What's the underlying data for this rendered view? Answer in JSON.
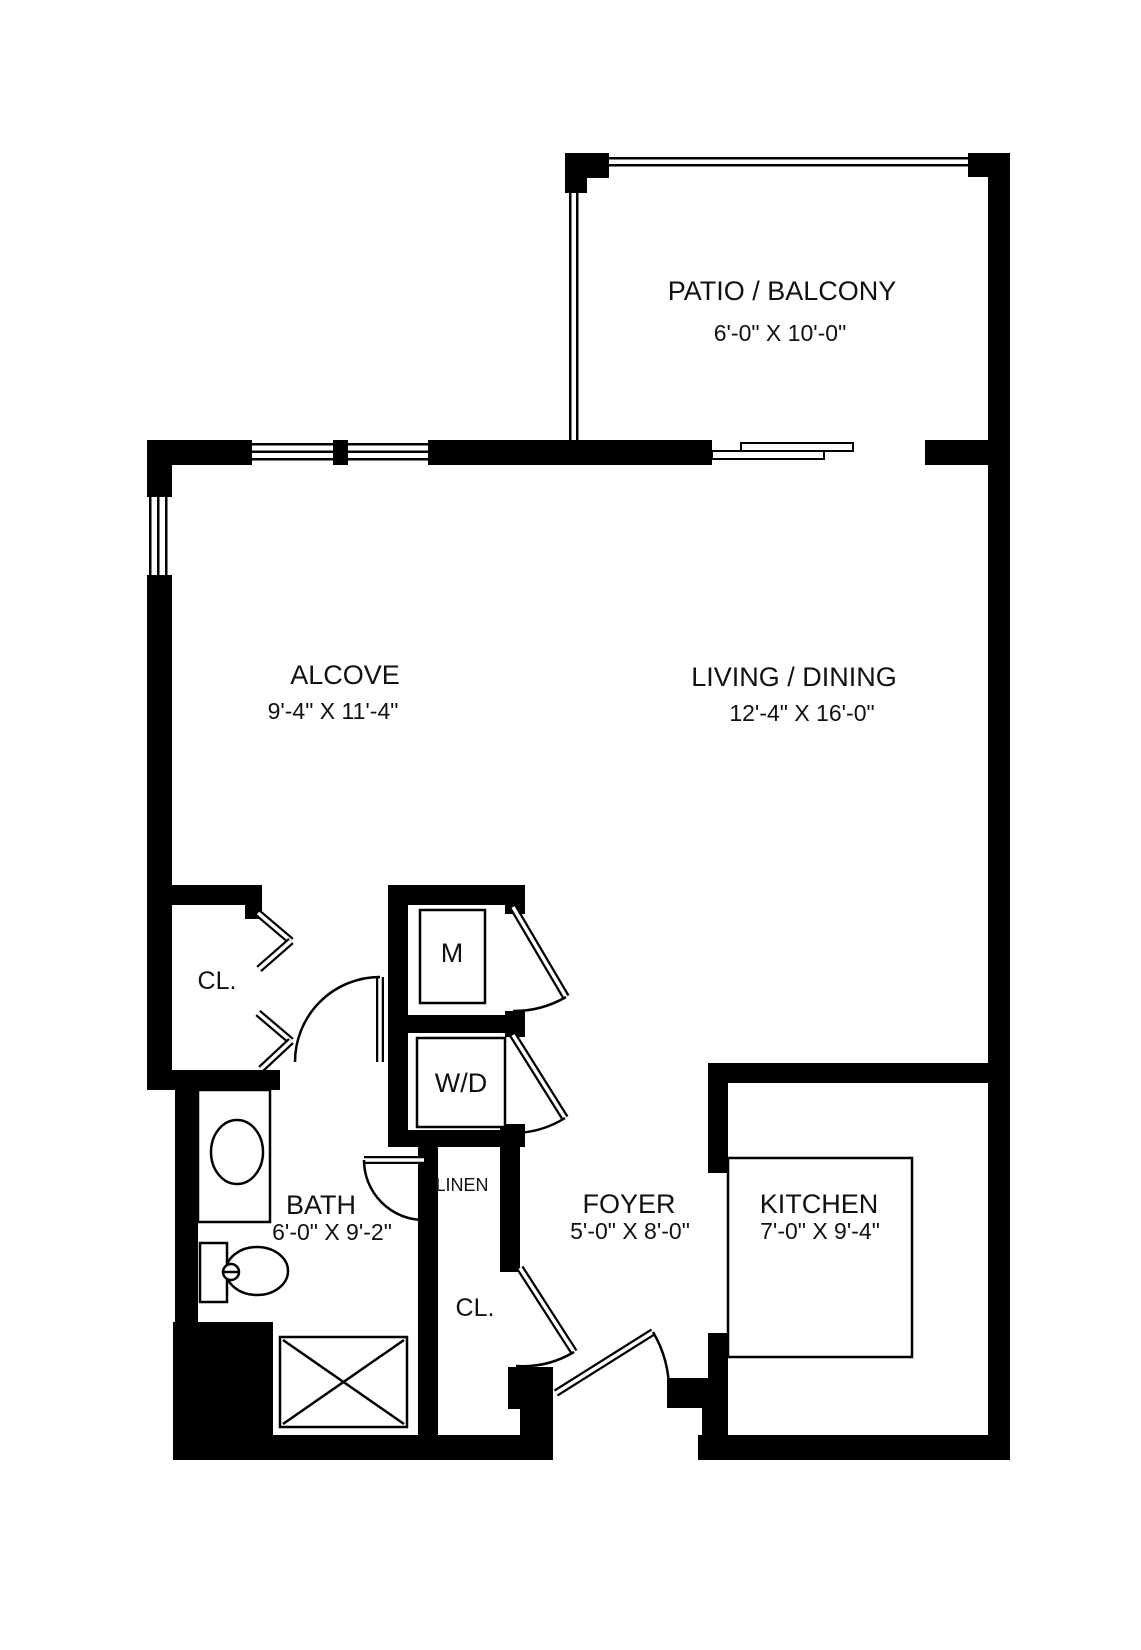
{
  "floor_plan": {
    "patio": {
      "name": "PATIO / BALCONY",
      "dims": "6'-0\" X 10'-0\""
    },
    "alcove": {
      "name": "ALCOVE",
      "dims": "9'-4\" X 11'-4\""
    },
    "living_dining": {
      "name": "LIVING / DINING",
      "dims": "12'-4\" X 16'-0\""
    },
    "bath": {
      "name": "BATH",
      "dims": "6'-0\" X 9'-2\""
    },
    "foyer": {
      "name": "FOYER",
      "dims": "5'-0\" X 8'-0\""
    },
    "kitchen": {
      "name": "KITCHEN",
      "dims": "7'-0\" X 9'-4\""
    },
    "alcove_closet": {
      "name": "CL."
    },
    "foyer_closet": {
      "name": "CL."
    },
    "linen_closet": {
      "name": "LINEN"
    },
    "mechanical_closet": {
      "name": "M"
    },
    "laundry_closet": {
      "name": "W/D"
    }
  },
  "colors": {
    "wall": "#000000",
    "background": "#ffffff"
  }
}
